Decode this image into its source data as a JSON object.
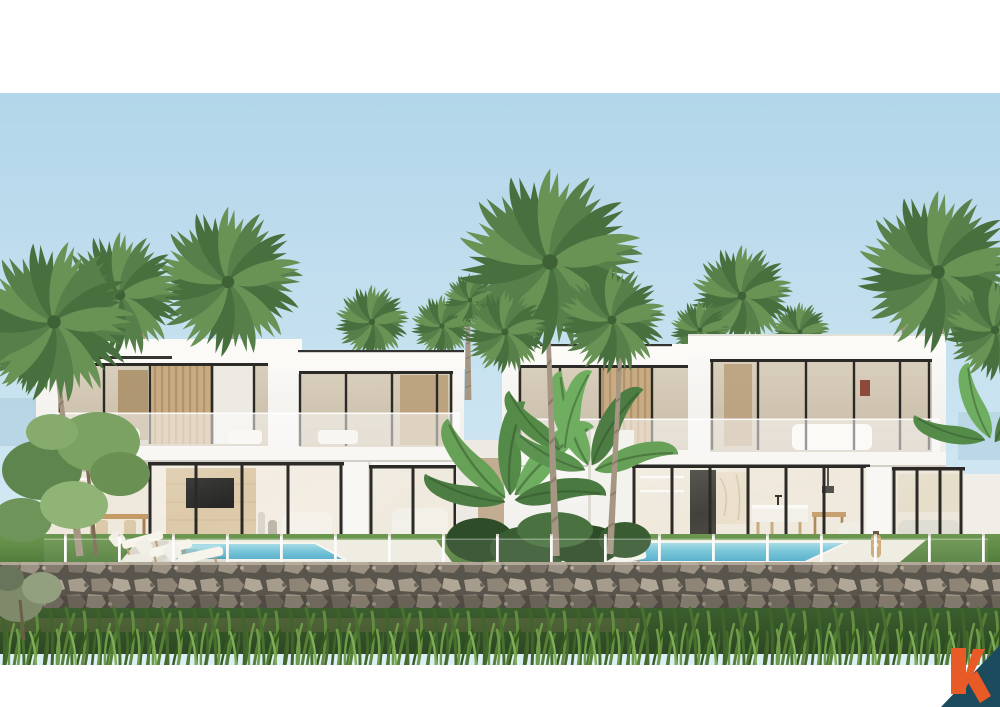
{
  "image": {
    "type": "3d-architectural-exterior-render",
    "subject": "Two modern two-storey white tropical villas with private pools",
    "setting": "Tropical garden with fan and coconut palms, banana plants, glass pool fence, natural stone retaining wall and wild grass in the foreground under a pale blue sky",
    "time_of_day": "day",
    "text_in_image": "none"
  },
  "frame": {
    "top_band": {
      "y": 0,
      "height": 93,
      "color": "#ffffff"
    },
    "bottom_band": {
      "y": 665,
      "height": 42,
      "color": "#ffffff"
    }
  },
  "sky": {
    "top": "#b2d6ea",
    "horizon": "#ddeef6"
  },
  "villas": {
    "count": 2,
    "left": {
      "storeys": 2,
      "roof": "flat white slab with dark shadow reveal",
      "upper_floor": [
        "full-height glazing with black frames",
        "timber slat wall",
        "sheer curtains",
        "frosted glass balustrade terrace"
      ],
      "ground_floor": [
        "open-air kitchen and dining with timber table",
        "travertine feature wall with wall-mounted TV",
        "black-framed glass sliding doors",
        "white lounge sofa"
      ],
      "pool": {
        "water_light": "#a8dce6",
        "water_deep": "#4aa9c8",
        "loungers": 3
      }
    },
    "right": {
      "storeys": 2,
      "roof": "flat white slab",
      "upper_floor": [
        "full-height glazing with black frames",
        "timber slat wall",
        "bedroom visible behind frosted balustrade"
      ],
      "ground_floor": [
        "marble kitchen island with bar stools",
        "timber dining set",
        "dark cabinetry column",
        "lounge sofa",
        "rattan floor lantern"
      ],
      "pool": {
        "water_light": "#a8dce6",
        "water_deep": "#4aa9c8",
        "loungers": 3
      }
    }
  },
  "vegetation": {
    "palms": [
      "tall fan palm between the villas",
      "coconut palm cluster on the left",
      "palm crowns behind both rooflines",
      "tall palm at the far right"
    ],
    "other": [
      "banana plants between the villas",
      "leafy tree at front left",
      "low shrubs",
      "lawn strips"
    ],
    "greens": [
      "#48703e",
      "#567f4a",
      "#699255"
    ]
  },
  "site": {
    "pool_fence": {
      "type": "frameless glass fence with slim white posts",
      "post_color": "#fcfcfb",
      "approx_posts": 18
    },
    "retaining_wall": {
      "material": "natural stone rubble masonry",
      "joint": "#5a554c",
      "stones": [
        "#a59c8c",
        "#8e8577",
        "#b0a797",
        "#7c7468",
        "#9c9384",
        "#857c6f"
      ]
    },
    "foreground": {
      "lawn": "#4e7a39",
      "tall_grass": [
        "#3f6429",
        "#577f36",
        "#628c3e"
      ]
    }
  },
  "logo": {
    "glyph": "k",
    "style": "orange letter over a dark teal triangle in the bottom-right corner",
    "orange": "#e85a26",
    "teal": "#1d4b5e"
  },
  "colors": {
    "villa_white": "#f7f6f2",
    "window_frame": "#2b2a27",
    "timber": "#c8ab82",
    "deck": "#eeebe0",
    "pool_light": "#a8dce6",
    "pool_deep": "#4aa9c8"
  }
}
